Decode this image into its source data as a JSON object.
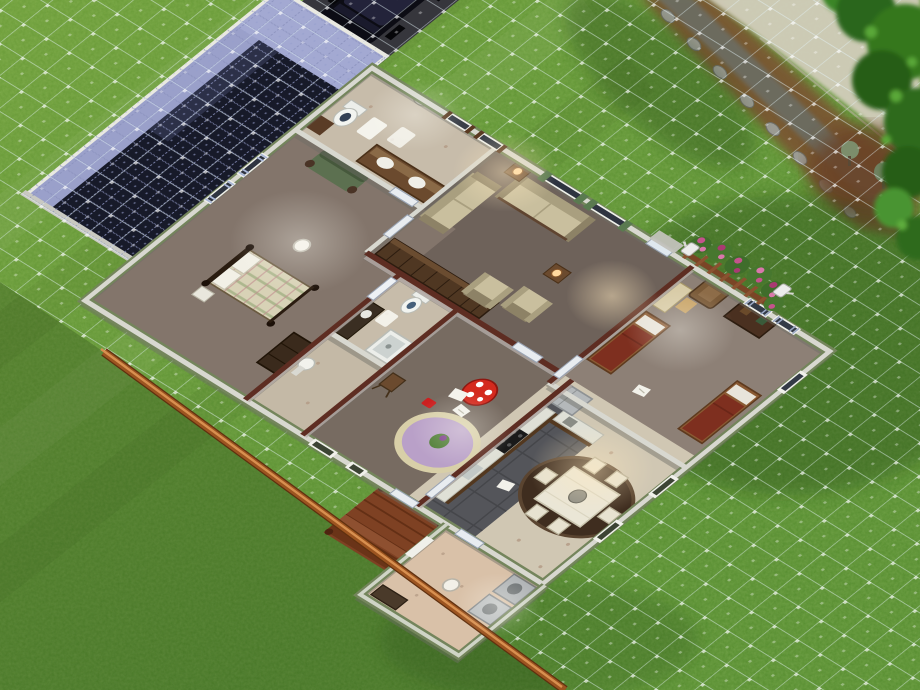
{
  "meta": {
    "scene": "Life-simulation game viewport: top-down cutaway (dollhouse) view of a suburban house on a grassy lot in build/buy mode",
    "hud_visible": false,
    "view_angle": "rotated isometric top-down"
  },
  "palette": {
    "grass_sun": "#6fa33c",
    "grass_base": "#548c2c",
    "grass_shadow": "#2f4f1d",
    "lot_grid_line": "#dceef6",
    "solar_panel_dark": "#171a29",
    "solar_panel_light": "#9aa0ca",
    "wall_stub": "#d8d8d0",
    "wall_tall_cap": "#5e2d22",
    "siding_green": "#74855c",
    "fascia_white": "#e9e9e1",
    "carpet_living": "#6e625a",
    "carpet_master": "#83756b",
    "lino_tan": "#c7bcaa",
    "lino_kitchen_floor": "#d0c7b3",
    "tile_kitchen": "#54555a",
    "laundry_floor": "#d9c1a8",
    "deck_wood": "#7e4123",
    "orange_wall": "#9c5420",
    "flower_pink": "#c4538c",
    "dirt_path": "#7a5232",
    "sidewalk": "#d5cfbf",
    "car_body": "#0c0c14"
  },
  "rooms": [
    {
      "id": "bathroom-main",
      "label": "Main bathroom: toilet, double-sink wood vanity, oval mirror, shuttered windows, bath mats, small cabinet"
    },
    {
      "id": "living-room",
      "label": "Living room: beige sofa, antique loveseat, two armchairs, end tables with lit lamps, long bookshelf wall, green-draped windows, front door"
    },
    {
      "id": "kids-bedroom",
      "label": "Kids bedroom: two single beds with dark red blankets, desk and chair, brown armchair, dark dresser, striped-curtain windows"
    },
    {
      "id": "master-bedroom",
      "label": "Master bedroom: four-poster bed with plaid quilt, green antique sofa, dark dresser, blue-curtain windows, ceiling lamp"
    },
    {
      "id": "bathroom-second",
      "label": "Second bathroom: toilet, shower stall, dark counter with basin, bath mat"
    },
    {
      "id": "back-hall",
      "label": "Back hallway with pedestal sink"
    },
    {
      "id": "playroom",
      "label": "Playroom: red toadstool toy table, lavender play rug with toy, small wooden easel chair, scattered papers"
    },
    {
      "id": "kitchen",
      "label": "Kitchen: L-shaped wood counters with white tops, black stove, sink, light gray refrigerator, dark tile floor"
    },
    {
      "id": "dining-area",
      "label": "Dining area: white cloth table with six white chairs on an oval dark-brown rug, speckled linoleum floor"
    },
    {
      "id": "laundry-porch",
      "label": "Enclosed laundry porch: washer and dryer, small counter, ceiling lamp, green walls"
    }
  ],
  "exterior": {
    "roof": "Solar-panel covered roof wing over garage",
    "car": "Black SUV parked on dark driveway",
    "flower_bed": "Wooden railing planter with pink roses and white watering cans along the front wall",
    "deck": "Red-brown wooden deck with steps",
    "dirt_path": "Dirt garden strip with gray stepping stones",
    "sidewalk": "Pale concrete sidewalk at top right",
    "trees": "Tree canopy and shrubs, top right corner",
    "lot_grid": "White-blue build-mode tile grid over the lot",
    "orange_wall": "Low orange-brown foundation wall along lower-left lot edge",
    "lawn": "Mottled green lawn with mow stripes and tree shadows"
  }
}
